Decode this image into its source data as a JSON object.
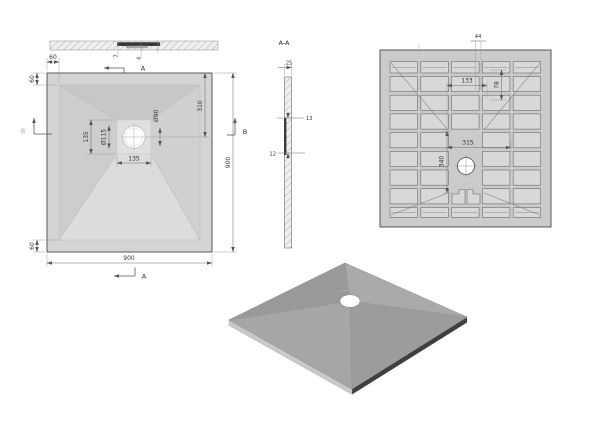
{
  "drawing": {
    "subject": "square shower tray technical drawing"
  },
  "front_view": {
    "dim_7": "7",
    "dim_4": "4"
  },
  "plan_view": {
    "dim_60_top_h": "60",
    "dim_60_top_v": "60",
    "dim_135_left": "135",
    "dim_dia_115": "Ø115",
    "dim_dia_90": "Ø90",
    "dim_310": "310",
    "dim_135_bottom": "135",
    "dim_900_right": "900",
    "dim_60_bottom": "60",
    "dim_900_bottom": "900",
    "marker_a_top": "A",
    "marker_a_bottom": "A",
    "marker_b_left": "B",
    "marker_b_right": "B"
  },
  "section_view": {
    "label": "A-A",
    "dim_25": "25",
    "dim_13": "13",
    "dim_12": "12"
  },
  "bottom_view": {
    "dim_44": "44",
    "dim_133": "133",
    "dim_78": "78",
    "dim_315": "315",
    "dim_340": "340"
  },
  "colors": {
    "line": "#4a4a4a",
    "plan_base": "#d4d4d4",
    "bottom_base": "#cbcbcb",
    "pocket": "#d8d8d8",
    "iso_top": "#a3a3a3",
    "drain": "#ffffff"
  }
}
